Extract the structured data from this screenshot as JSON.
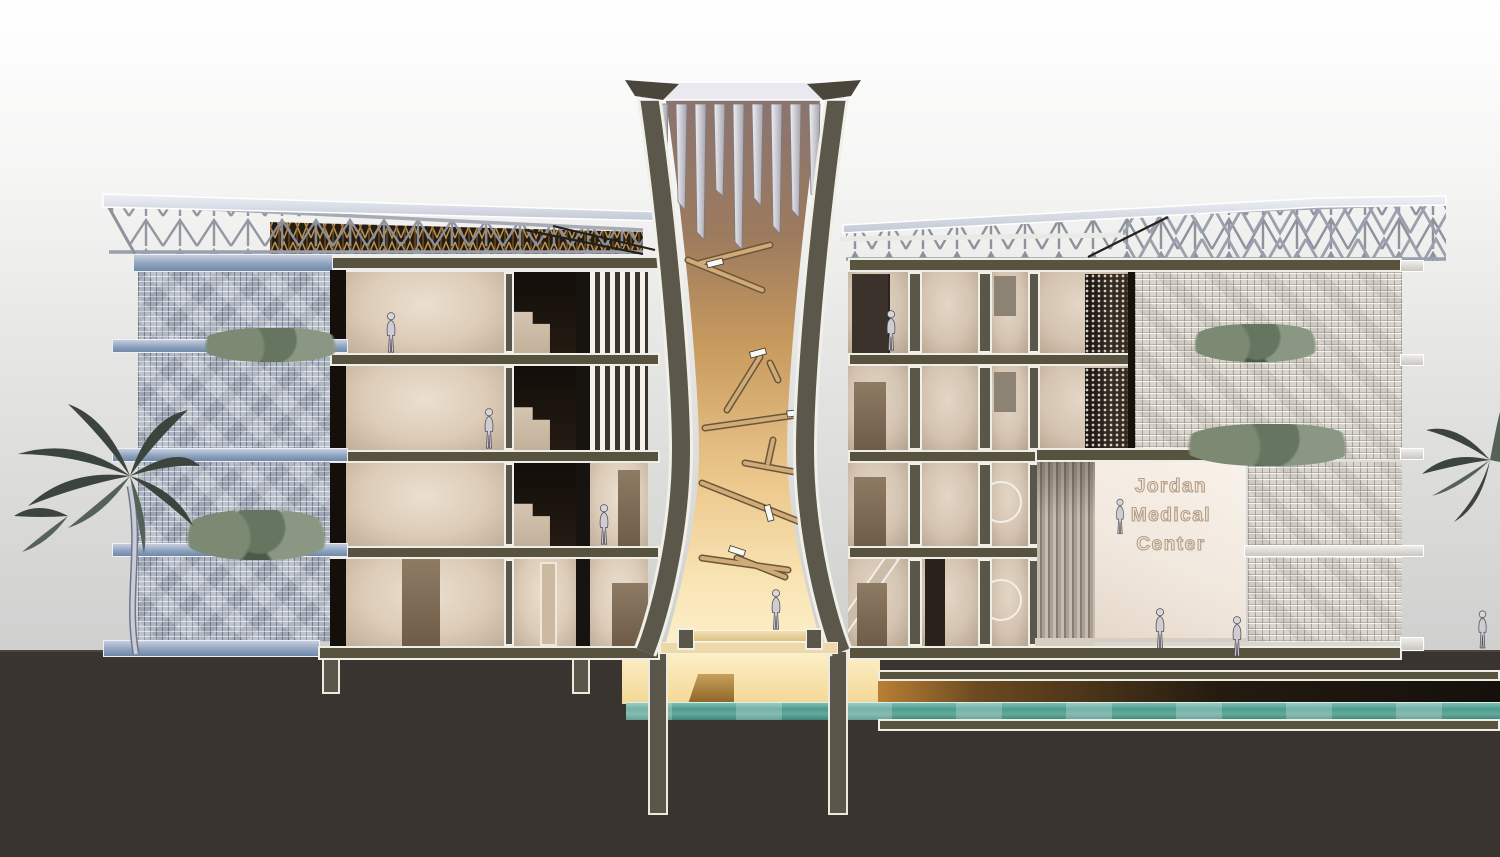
{
  "scene": {
    "description": "Architectural cross-section rendering of a four-storey medical center with a central hourglass-shaped light chimney atrium, sloped steel-truss butterfly roofs, brick screen facades with planted balconies, a double-height entrance lobby and a basement level with a pool of water",
    "building_name": "Jordan Medical Center"
  },
  "sign": {
    "lines": [
      "Jordan",
      "Medical",
      "Center"
    ]
  },
  "building": {
    "floors_above_ground": 4,
    "has_basement": true,
    "basement_feature": "water pool",
    "central_feature": "hourglass light-chimney atrium with louvered top and timber struts"
  },
  "entourage": {
    "people_count": 9,
    "palm_trees": 2,
    "facade_planters": 4
  },
  "palette": {
    "cut_structure_olive": "#5a564a",
    "outline_white": "#f0efe8",
    "ground_dark": "#3a3431",
    "water_teal": "#5fa89d",
    "atrium_glow_top": "#8a7470",
    "atrium_glow_bottom": "#fdf0cd",
    "brick_screen_blue": "#aeb5c2",
    "brick_screen_light": "#d9d5cd",
    "steel_truss": "#8d929d",
    "timber_lattice": "#bd9350",
    "interior_beige": "#dcccb8",
    "sign_outline": "#b49e87"
  }
}
